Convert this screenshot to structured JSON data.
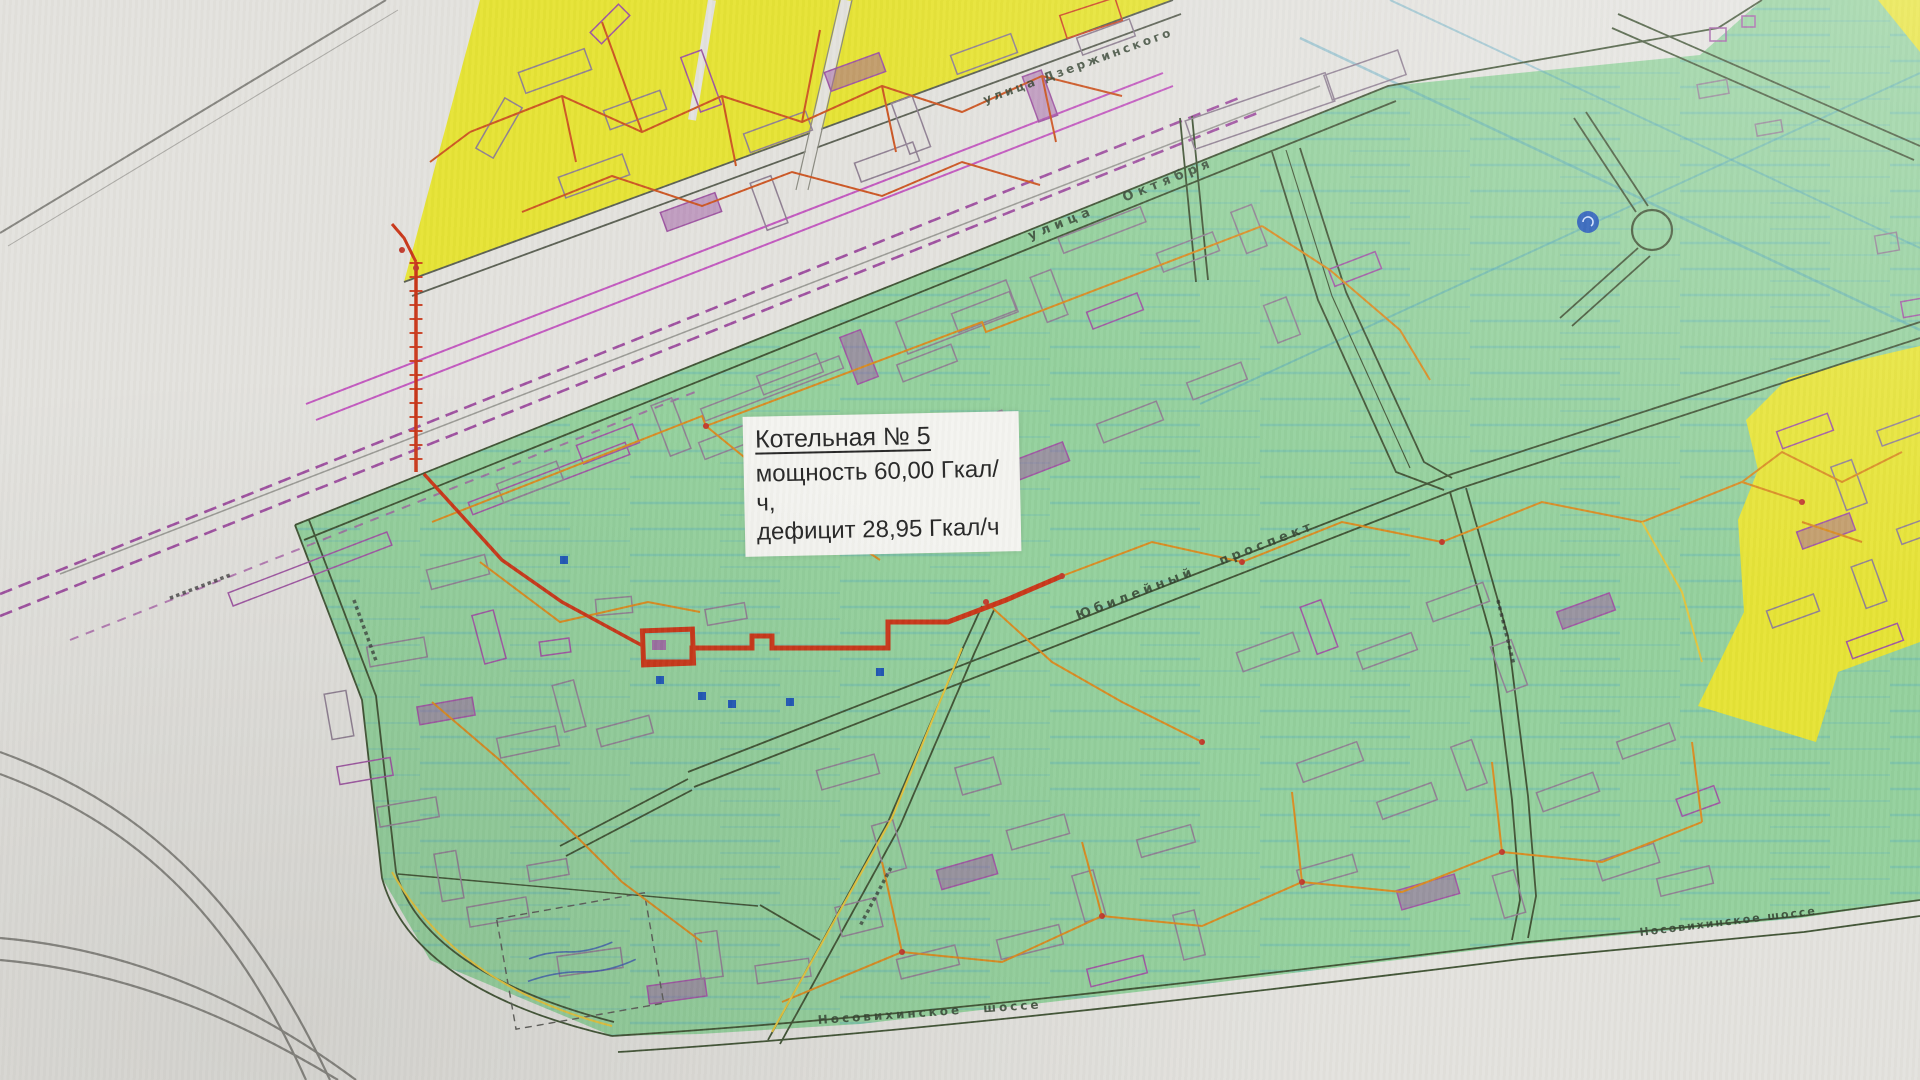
{
  "map": {
    "title": "Схема теплоснабжения — зона котельной № 5",
    "annotation_box": {
      "title": "Котельная № 5",
      "capacity_line": "мощность 60,00 Гкал/ч,",
      "deficit_line": "дефицит 28,95 Гкал/ч"
    },
    "street_labels": {
      "dzerzhinskogo": "улица Дзержинского",
      "oktyabrya": "улица Октября",
      "yubileyny_prospekt": "Юбилейный проспект",
      "nosovikhinskoye_center": "Носовихинское шоссе",
      "nosovikhinskoye_right": "Носовихинское шоссе"
    },
    "unreadable_label_marks": "▪▪▪▪▪▪▪▪▪▪",
    "colors": {
      "paper": "#e3e2de",
      "zone_yellow": "#e6e333",
      "zone_green": "#93d09c",
      "road_dark": "#3f5233",
      "road_gray": "#85847f",
      "railway_purple": "#9e4fa0",
      "magenta_line": "#c257bf",
      "pipe_orange": "#d98a1f",
      "pipe_orange2": "#cc5522",
      "pipe_yellow": "#e3c43c",
      "pipe_red": "#c93517",
      "building_gray": "#8f7f92",
      "building_purple": "#9e55a2",
      "marker_blue": "#1f56b5",
      "stream_cyan": "#4aa8c0"
    }
  }
}
